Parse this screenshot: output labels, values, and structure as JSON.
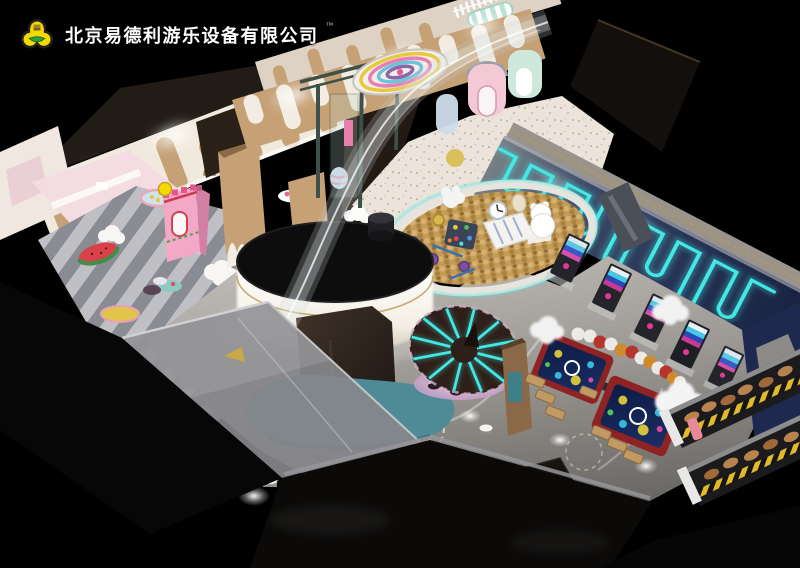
{
  "header": {
    "company_name": "北京易德利游乐设备有限公司",
    "trademark": "™"
  },
  "icons": {
    "logo": "clover-trefoil-leaf-logo"
  },
  "colors": {
    "background": "#000000",
    "neon_cyan": "#43e8e4",
    "navy_wall": "#2c3a60",
    "navy_carpet": "#1e2950",
    "wood": "#c6a176",
    "cream": "#f1e9dd",
    "pink_room": "#f4dde2",
    "castle_pink": "#f3a9c6",
    "gold_balls": "#c49c58",
    "floor_gray": "#a5a29d",
    "teal_base": "#4e8b96",
    "logo_yellow": "#f2d900",
    "logo_green": "#2f9e3c",
    "table_red": "#8f2324",
    "shelf_yellow": "#e3b92c",
    "cloud_white": "#f6f6f6",
    "canopy_brown": "#2e2019"
  }
}
